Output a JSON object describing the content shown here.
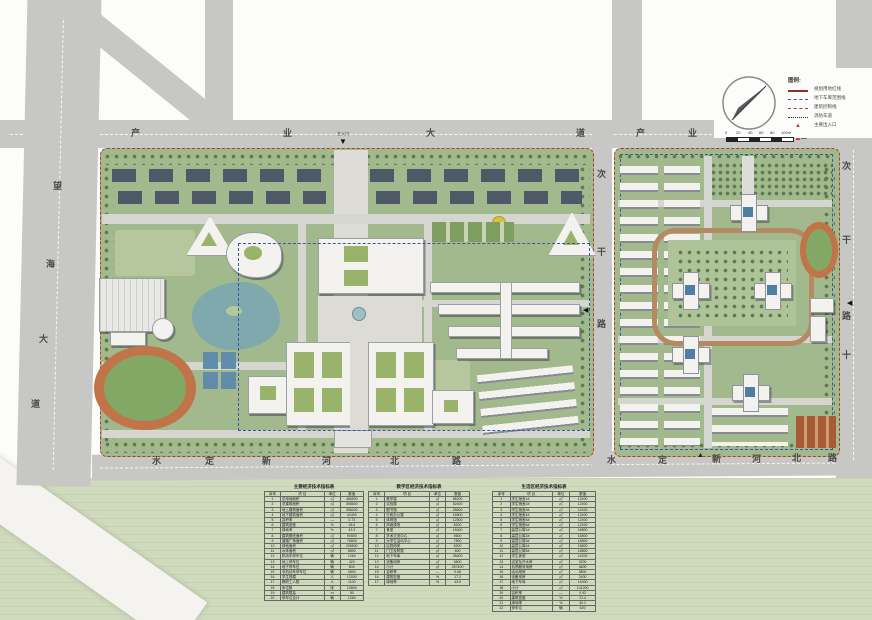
{
  "title": "校园总平面规划图",
  "roads": {
    "north1": {
      "name": "产业大道",
      "chars": [
        "产",
        "业",
        "大",
        "道"
      ]
    },
    "north2": {
      "name": "产业大道",
      "chars": [
        "产",
        "业",
        "大",
        "道"
      ]
    },
    "west": {
      "name": "望海大道",
      "chars": [
        "望",
        "海",
        "大",
        "道"
      ]
    },
    "middle": {
      "name": "次干路",
      "chars": [
        "次",
        "干",
        "路"
      ]
    },
    "east": {
      "name": "次干路十",
      "chars": [
        "次",
        "干",
        "路",
        "十"
      ]
    },
    "south1": {
      "name": "水定新河北路",
      "chars": [
        "水",
        "定",
        "新",
        "河",
        "北",
        "路"
      ]
    },
    "south2": {
      "name": "水定新河北路",
      "chars": [
        "水",
        "定",
        "新",
        "河",
        "北",
        "路"
      ]
    }
  },
  "markers": {
    "main_gate_label": "主入口"
  },
  "legend": {
    "title": "图例:",
    "items": [
      {
        "label": "规划用地红线",
        "type": "solid-red"
      },
      {
        "label": "地下车库范围线",
        "type": "dash-blue"
      },
      {
        "label": "建筑控制线",
        "type": "dash-red"
      },
      {
        "label": "消防车道",
        "type": "dot-black"
      },
      {
        "label": "主要出入口",
        "type": "red-triangle"
      }
    ]
  },
  "scalebar": {
    "labels": [
      "0",
      "20",
      "40",
      "60",
      "80",
      "100m"
    ]
  },
  "tables": [
    {
      "title": "主要经济技术指标表",
      "headers": [
        "序号",
        "项 目",
        "单位",
        "数值"
      ],
      "rows": [
        [
          "1",
          "总用地面积",
          "㎡",
          "486500"
        ],
        [
          "2",
          "总建筑面积",
          "㎡",
          "398600"
        ],
        [
          "3",
          "地上建筑面积",
          "㎡",
          "356200"
        ],
        [
          "4",
          "地下建筑面积",
          "㎡",
          "42400"
        ],
        [
          "5",
          "容积率",
          "—",
          "0.73"
        ],
        [
          "6",
          "建筑密度",
          "%",
          "18.6"
        ],
        [
          "7",
          "绿地率",
          "%",
          "42.3"
        ],
        [
          "8",
          "建筑基底面积",
          "㎡",
          "90500"
        ],
        [
          "9",
          "道路广场面积",
          "㎡",
          "76800"
        ],
        [
          "10",
          "绿地面积",
          "㎡",
          "205800"
        ],
        [
          "11",
          "水体面积",
          "㎡",
          "8600"
        ],
        [
          "12",
          "机动车停车位",
          "辆",
          "1260"
        ],
        [
          "13",
          "地上停车位",
          "辆",
          "420"
        ],
        [
          "14",
          "地下停车位",
          "辆",
          "840"
        ],
        [
          "15",
          "非机动车停车位",
          "辆",
          "3500"
        ],
        [
          "16",
          "学生规模",
          "人",
          "12000"
        ],
        [
          "17",
          "教职工人数",
          "人",
          "1100"
        ],
        [
          "18",
          "床位数",
          "床",
          "10800"
        ],
        [
          "19",
          "建筑限高",
          "m",
          "50"
        ],
        [
          "20",
          "停车位合计",
          "辆",
          "1260"
        ]
      ]
    },
    {
      "title": "教学区经济技术指标表",
      "headers": [
        "序号",
        "项 目",
        "单位",
        "数值"
      ],
      "rows": [
        [
          "1",
          "教学楼",
          "㎡",
          "68200"
        ],
        [
          "2",
          "实验楼",
          "㎡",
          "52400"
        ],
        [
          "3",
          "图书馆",
          "㎡",
          "28600"
        ],
        [
          "4",
          "行政办公楼",
          "㎡",
          "16800"
        ],
        [
          "5",
          "体育馆",
          "㎡",
          "12600"
        ],
        [
          "6",
          "风雨操场",
          "㎡",
          "8200"
        ],
        [
          "7",
          "食堂",
          "㎡",
          "15400"
        ],
        [
          "8",
          "学术交流中心",
          "㎡",
          "9600"
        ],
        [
          "9",
          "大学生活动中心",
          "㎡",
          "7800"
        ],
        [
          "10",
          "后勤用房",
          "㎡",
          "5200"
        ],
        [
          "11",
          "门卫及附属",
          "㎡",
          "600"
        ],
        [
          "12",
          "地下车库",
          "㎡",
          "28400"
        ],
        [
          "13",
          "设备用房",
          "㎡",
          "3600"
        ],
        [
          "14",
          "小计",
          "㎡",
          "257400"
        ],
        [
          "15",
          "容积率",
          "—",
          "0.68"
        ],
        [
          "16",
          "建筑密度",
          "%",
          "17.2"
        ],
        [
          "17",
          "绿地率",
          "%",
          "43.5"
        ]
      ]
    },
    {
      "title": "生活区经济技术指标表",
      "headers": [
        "序号",
        "项 目",
        "单位",
        "数值"
      ],
      "rows": [
        [
          "1",
          "学生宿舍1#",
          "㎡",
          "12400"
        ],
        [
          "2",
          "学生宿舍2#",
          "㎡",
          "12400"
        ],
        [
          "3",
          "学生宿舍3#",
          "㎡",
          "12400"
        ],
        [
          "4",
          "学生宿舍4#",
          "㎡",
          "12400"
        ],
        [
          "5",
          "学生宿舍5#",
          "㎡",
          "12400"
        ],
        [
          "6",
          "学生宿舍6#",
          "㎡",
          "12400"
        ],
        [
          "7",
          "高层公寓1#",
          "㎡",
          "16800"
        ],
        [
          "8",
          "高层公寓2#",
          "㎡",
          "16800"
        ],
        [
          "9",
          "高层公寓3#",
          "㎡",
          "16800"
        ],
        [
          "10",
          "高层公寓4#",
          "㎡",
          "16800"
        ],
        [
          "11",
          "高层公寓5#",
          "㎡",
          "16800"
        ],
        [
          "12",
          "学生食堂",
          "㎡",
          "14200"
        ],
        [
          "13",
          "浴室及开水房",
          "㎡",
          "3200"
        ],
        [
          "14",
          "后勤服务用房",
          "㎡",
          "4600"
        ],
        [
          "15",
          "活动用房",
          "㎡",
          "5800"
        ],
        [
          "16",
          "设备用房",
          "㎡",
          "2400"
        ],
        [
          "17",
          "地下车库",
          "㎡",
          "14000"
        ],
        [
          "18",
          "小计",
          "㎡",
          "141200"
        ],
        [
          "19",
          "容积率",
          "—",
          "0.92"
        ],
        [
          "20",
          "建筑密度",
          "%",
          "21.4"
        ],
        [
          "21",
          "绿地率",
          "%",
          "40.2"
        ],
        [
          "22",
          "停车位",
          "辆",
          "620"
        ]
      ]
    }
  ]
}
